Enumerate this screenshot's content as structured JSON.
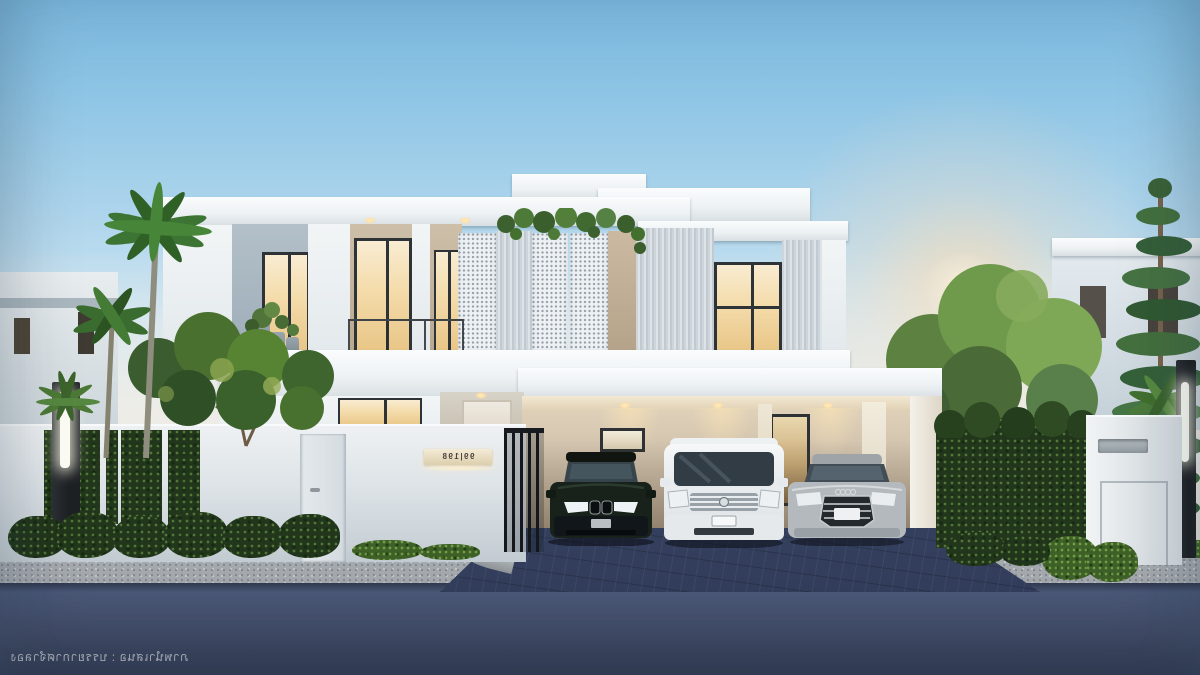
{
  "scene": {
    "description": "Modern two-storey white house at dusk with carport, three parked cars, hedge fence walls, palm and pine trees, and strip street lights"
  },
  "watermark": {
    "text": "ภาพนำเสนอ : บรรยากาศจำลอง",
    "mirrored": true
  },
  "address_plaque": {
    "text": "99|198",
    "mirrored": true
  },
  "vehicles": {
    "left": "dark green luxury SUV",
    "center": "white luxury MPV van",
    "right": "silver luxury sedan"
  },
  "palette": {
    "sky_top": "#79b6dc",
    "sky_horizon": "#eee9e2",
    "sun_glow": "#ffddb2",
    "house_white": "#f2f5f6",
    "house_gray_panel": "#b9c5cd",
    "slat_cladding": "#cdd5db",
    "warm_window_light": "#f4dcab",
    "carport_wall": "#cfc0ab",
    "hedge_green": "#22361c",
    "lawn_green": "#3f6128",
    "road": "#47536f",
    "sidewalk": "#a6abb0",
    "driveway_pavers": "#333f5d",
    "fence_white": "#e7ebee",
    "light_post": "#24282c",
    "plaque_cream": "#e9ddc4"
  }
}
